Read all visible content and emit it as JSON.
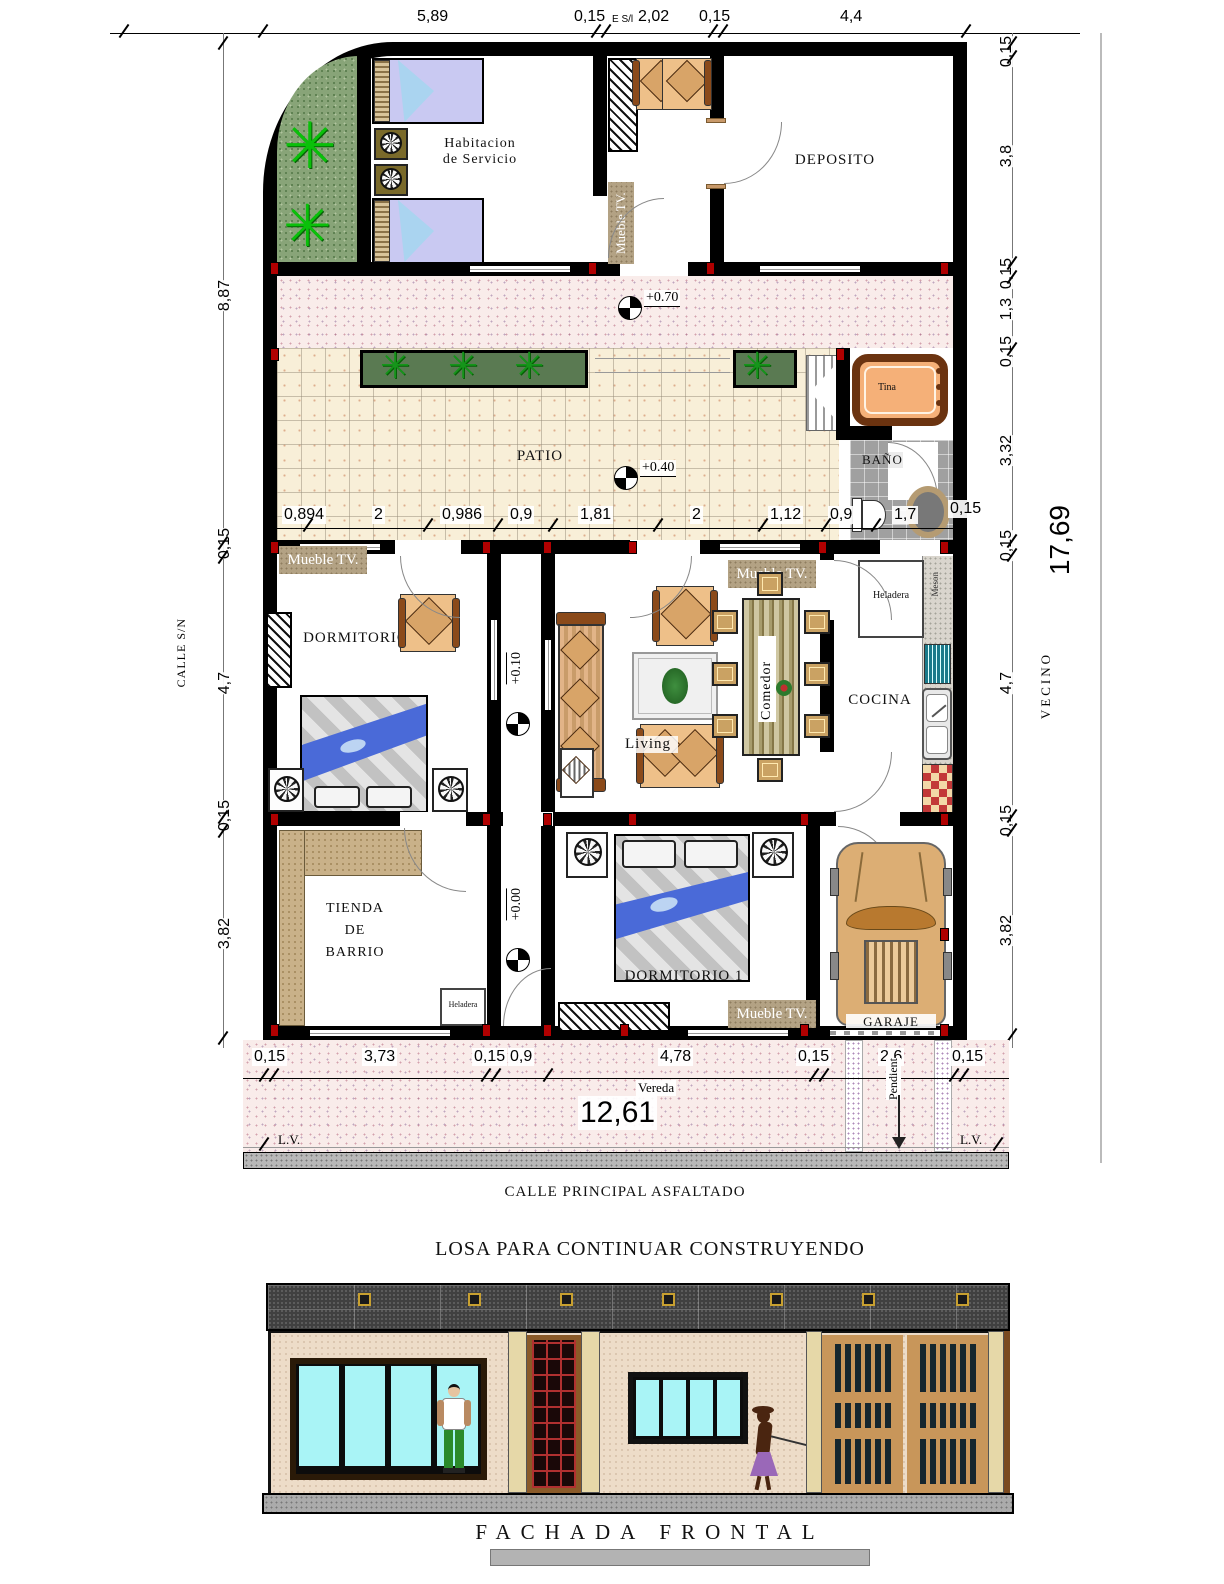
{
  "plan": {
    "rooms": {
      "servicio_line1": "Habitacion",
      "servicio_line2": "de Servicio",
      "deposito": "DEPOSITO",
      "patio": "PATIO",
      "bano": "BAÑO",
      "dormitorio2": "DORMITORIO 2",
      "living": "Living",
      "comedor": "Comedor",
      "cocina": "COCINA",
      "tienda_line1": "TIENDA",
      "tienda_line2": "DE",
      "tienda_line3": "BARRIO",
      "dormitorio1": "DORMITORIO 1",
      "garaje": "GARAJE"
    },
    "furniture": {
      "mueble_tv": "Mueble TV.",
      "tina": "Tina",
      "heladera": "Heladera",
      "meson": "Meson"
    },
    "elevations": {
      "walkway": "+0.70",
      "patio": "+0.40",
      "living": "+0.10",
      "entry": "+0.00"
    },
    "dims": {
      "top": [
        "5,89",
        "0,15",
        "E S/l",
        "2,02",
        "0,15",
        "4,4"
      ],
      "left": [
        "8,87",
        "0,15",
        "4,7",
        "0,15",
        "3,82"
      ],
      "right": [
        "0,15",
        "3,8",
        "0,15",
        "1,3",
        "0,15",
        "3,32",
        "0,15",
        "4,7",
        "0,15",
        "3,82"
      ],
      "right_total": "17,69",
      "patio": [
        "0,894",
        "2",
        "0,986",
        "0,9",
        "1,81",
        "2",
        "1,12",
        "0,9",
        "1,7",
        "0,15"
      ],
      "bottom": [
        "0,15",
        "3,73",
        "0,15",
        "0,9",
        "4,78",
        "0,15",
        "2,6",
        "0,15"
      ],
      "bottom_total": "12,61"
    },
    "context": {
      "calle_sn": "CALLE S/N",
      "vecino": "VECINO",
      "vereda": "Vereda",
      "pendiente": "Pendient",
      "lv": "L.V.",
      "calle_principal": "CALLE PRINCIPAL ASFALTADO"
    }
  },
  "facade": {
    "title": "LOSA PARA CONTINUAR CONSTRUYENDO",
    "caption": "FACHADA FRONTAL"
  }
}
